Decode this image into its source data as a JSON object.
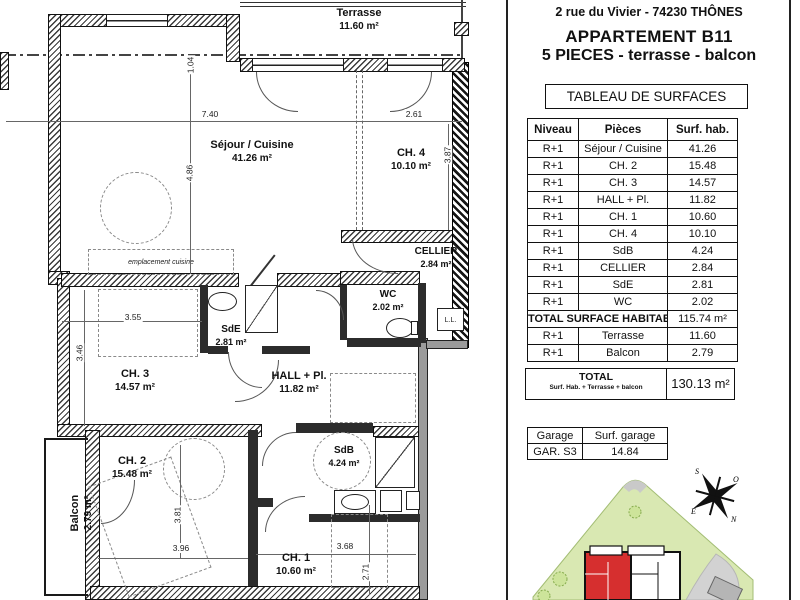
{
  "header": {
    "address": "2 rue du Vivier - 74230 THÔNES",
    "apartment": "APPARTEMENT B11",
    "subtitle": "5 PIECES - terrasse - balcon",
    "table_title": "TABLEAU DE SURFACES"
  },
  "surface_table": {
    "columns": [
      "Niveau",
      "Pièces",
      "Surf. hab."
    ],
    "rows": [
      {
        "niveau": "R+1",
        "piece": "Séjour / Cuisine",
        "surface": "41.26"
      },
      {
        "niveau": "R+1",
        "piece": "CH. 2",
        "surface": "15.48"
      },
      {
        "niveau": "R+1",
        "piece": "CH. 3",
        "surface": "14.57"
      },
      {
        "niveau": "R+1",
        "piece": "HALL + Pl.",
        "surface": "11.82"
      },
      {
        "niveau": "R+1",
        "piece": "CH. 1",
        "surface": "10.60"
      },
      {
        "niveau": "R+1",
        "piece": "CH. 4",
        "surface": "10.10"
      },
      {
        "niveau": "R+1",
        "piece": "SdB",
        "surface": "4.24"
      },
      {
        "niveau": "R+1",
        "piece": "CELLIER",
        "surface": "2.84"
      },
      {
        "niveau": "R+1",
        "piece": "SdE",
        "surface": "2.81"
      },
      {
        "niveau": "R+1",
        "piece": "WC",
        "surface": "2.02"
      }
    ],
    "total_label": "TOTAL SURFACE HABITABLE",
    "total_value": "115.74 m²",
    "extra_rows": [
      {
        "niveau": "R+1",
        "piece": "Terrasse",
        "surface": "11.60"
      },
      {
        "niveau": "R+1",
        "piece": "Balcon",
        "surface": "2.79"
      }
    ]
  },
  "total_box": {
    "label": "TOTAL",
    "sublabel": "Surf. Hab. + Terrasse + balcon",
    "value": "130.13 m²"
  },
  "garage_table": {
    "header": [
      "Garage",
      "Surf. garage"
    ],
    "row": [
      "GAR. S3",
      "14.84"
    ]
  },
  "floorplan": {
    "rooms": [
      {
        "name": "Terrasse",
        "area": "11.60 m²"
      },
      {
        "name": "Séjour / Cuisine",
        "area": "41.26 m²"
      },
      {
        "name": "CH. 4",
        "area": "10.10 m²"
      },
      {
        "name": "CELLIER",
        "area": "2.84 m²"
      },
      {
        "name": "WC",
        "area": "2.02 m²"
      },
      {
        "name": "SdE",
        "area": "2.81 m²"
      },
      {
        "name": "CH. 3",
        "area": "14.57 m²"
      },
      {
        "name": "HALL + Pl.",
        "area": "11.82 m²"
      },
      {
        "name": "CH. 2",
        "area": "15.48 m²"
      },
      {
        "name": "Balcon",
        "area": "2.79 m²"
      },
      {
        "name": "SdB",
        "area": "4.24 m²"
      },
      {
        "name": "CH. 1",
        "area": "10.60 m²"
      }
    ],
    "dims": {
      "sejour_w": "7.40",
      "sejour_h": "4.86",
      "axis_offset": "1.04",
      "ch4_w": "2.61",
      "ch4_h": "3.87",
      "ch3_w": "3.55",
      "ch3_h": "3.46",
      "ch2_w": "3.96",
      "ch2_h": "3.81",
      "ch1_w": "3.68",
      "ch1_h": "2.71"
    },
    "annotations": {
      "kitchen_placement": "emplacement cuisine",
      "washing_machine": "L.L."
    },
    "compass": {
      "north": "N",
      "south": "S",
      "east": "E",
      "west": "O"
    }
  },
  "colors": {
    "apartment_highlight": "#d62f2f",
    "site_green": "#d9e8b2",
    "site_gray": "#cfcfcf",
    "wall": "#1a1a1a"
  }
}
